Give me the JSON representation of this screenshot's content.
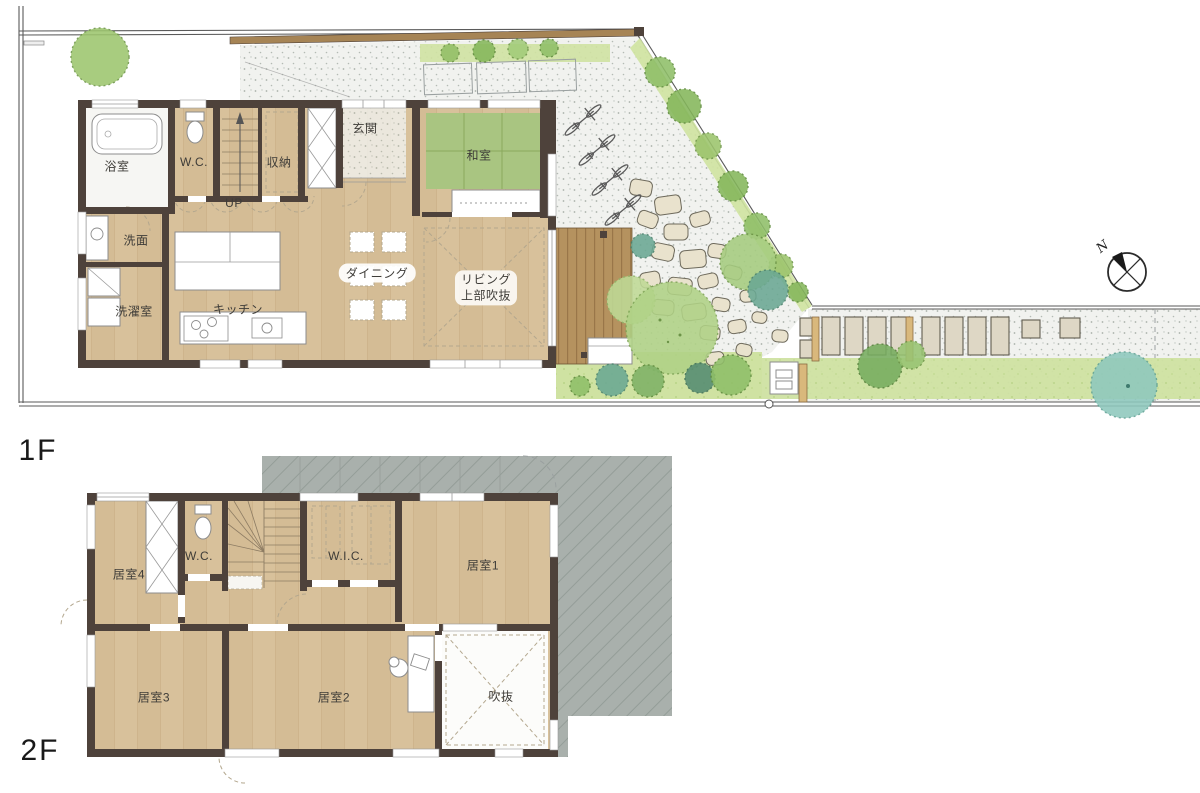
{
  "floor1": {
    "label": "1F",
    "rooms": {
      "bath": "浴室",
      "wc": "W.C.",
      "storage": "収納",
      "entrance": "玄関",
      "tatami": "和室",
      "up": "UP",
      "washroom": "洗面",
      "laundry": "洗濯室",
      "kitchen": "キッチン",
      "dining": "ダイニング",
      "living_line1": "リビング",
      "living_line2": "上部吹抜"
    }
  },
  "floor2": {
    "label": "2F",
    "rooms": {
      "room4": "居室4",
      "wc": "W.C.",
      "wic": "W.I.C.",
      "room1": "居室1",
      "room3": "居室3",
      "room2": "居室2",
      "void": "吹抜"
    }
  },
  "compass": {
    "north": "N"
  },
  "colors": {
    "wall": "#4e423b",
    "floor": "#d8c19b",
    "tatami": "#a9c581",
    "deck": "#b5925f",
    "roof": "#a9b0ac",
    "grass": "#cfe2a2",
    "tree_green": "#9cc46c",
    "tree_teal": "#8ec8bd",
    "stone": "#e9e2cd",
    "fence": "#a68455"
  }
}
